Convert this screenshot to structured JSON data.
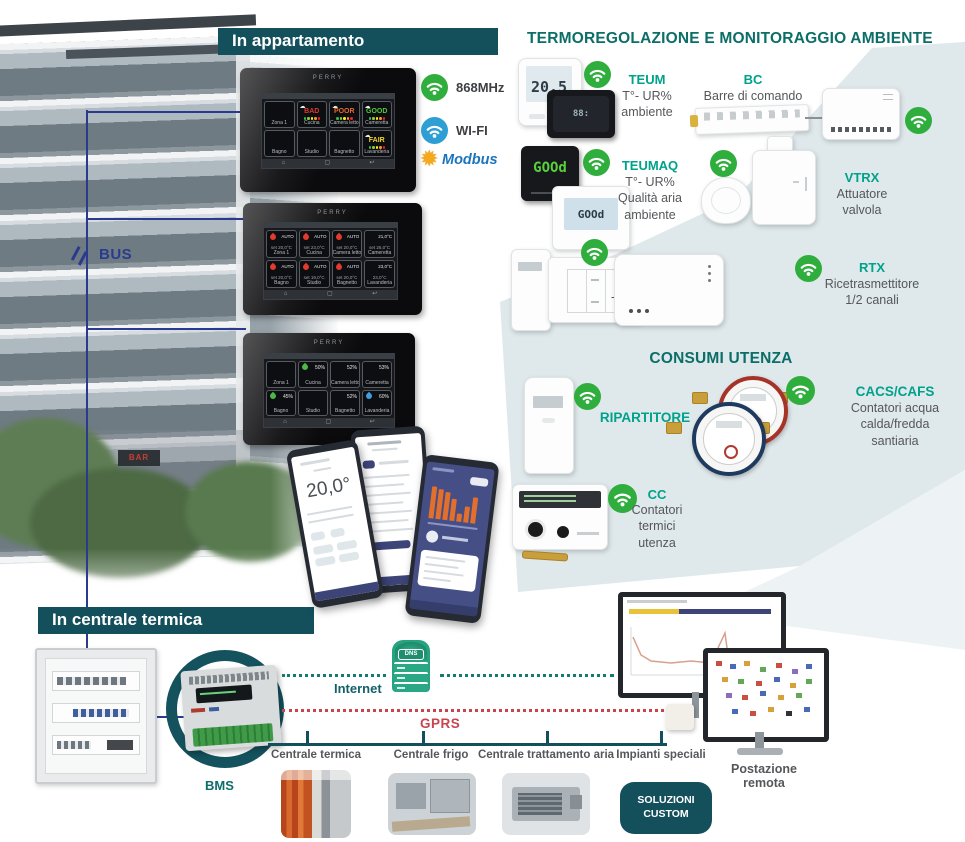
{
  "colors": {
    "header_bg": "#14505c",
    "title_teal": "#0b6e68",
    "product_teal": "#00a28b",
    "text_gray": "#55575a",
    "bus_navy": "#2a3b8f",
    "wifi_green": "#2fae3d",
    "wifi_blue": "#2e9fd4",
    "modbus_blue": "#1b75bc",
    "modbus_yellow": "#f5a81c",
    "gprs_red": "#c9444d",
    "internet_teal": "#135f6b",
    "dotted_teal": "#167a74",
    "shade_blue_gray": "#d9e4e8",
    "status_bad": "#e03a2e",
    "status_poor": "#e8682c",
    "status_good": "#53c83b",
    "status_fair": "#f2d729"
  },
  "apartment": {
    "header": "In appartamento",
    "bus_label": "BUS",
    "brand": "PERRY",
    "bar_sign": "BAR",
    "badges": [
      {
        "label": "868MHz",
        "icon": "wifi-green"
      },
      {
        "label": "WI-FI",
        "icon": "wifi-blue"
      },
      {
        "label": "Modbus",
        "icon": "modbus-star"
      }
    ],
    "rooms": [
      "Zona 1",
      "Cucina",
      "Camera letto",
      "Cameretta",
      "Bagno",
      "Studio",
      "Bagnetto",
      "Lavanderia"
    ],
    "air_quality": [
      "",
      "BAD",
      "POOR",
      "GOOD",
      "",
      "",
      "",
      "FAIR"
    ],
    "temp_modes": [
      "AUTO",
      "AUTO",
      "AUTO",
      "21,0°C",
      "AUTO",
      "AUTO",
      "AUTO",
      "23,0°C"
    ],
    "temp_sets": [
      "set 20,0°C",
      "set 23,0°C",
      "set 20,0°C",
      "set 26,0°C",
      "set 20,0°C",
      "set 19,0°C",
      "set 20,0°C",
      "23,0°C"
    ],
    "humidity": [
      "",
      "50%",
      "52%",
      "53%",
      "45%",
      "",
      "52%",
      "60%"
    ],
    "phone_temp": "20,0°"
  },
  "thermo": {
    "title": "TERMOREGOLAZIONE E MONITORAGGIO AMBIENTE",
    "teum_lcd": "20,5",
    "teumaq_lcd": "GOOd",
    "products": [
      {
        "name": "TEUM",
        "desc": "T°- UR%\nambiente"
      },
      {
        "name": "BC",
        "desc": "Barre di comando"
      },
      {
        "name": "TEUMAQ",
        "desc": "T°- UR%\nQualità aria\nambiente"
      },
      {
        "name": "VTRX",
        "desc": "Attuatore\nvalvola"
      },
      {
        "name": "STX",
        "desc": "T° ambiente"
      },
      {
        "name": "RTX",
        "desc": "Ricetrasmettitore\n1/2 canali"
      }
    ]
  },
  "consumi": {
    "title": "CONSUMI UTENZA",
    "products": [
      {
        "name": "RIPARTITORE",
        "desc": ""
      },
      {
        "name": "CACS/CAFS",
        "desc": "Contatori acqua\ncalda/fredda\nsantiaria"
      },
      {
        "name": "CC",
        "desc": "Contatori\ntermici\nutenza"
      }
    ]
  },
  "plant": {
    "header": "In centrale termica",
    "bms": "BMS",
    "dns": "DNS",
    "internet": "Internet",
    "gprs": "GPRS",
    "branches": [
      "Centrale termica",
      "Centrale frigo",
      "Centrale trattamento aria",
      "Impianti speciali"
    ],
    "custom_button": "SOLUZIONI\nCUSTOM",
    "remote": "Postazione\nremota"
  }
}
